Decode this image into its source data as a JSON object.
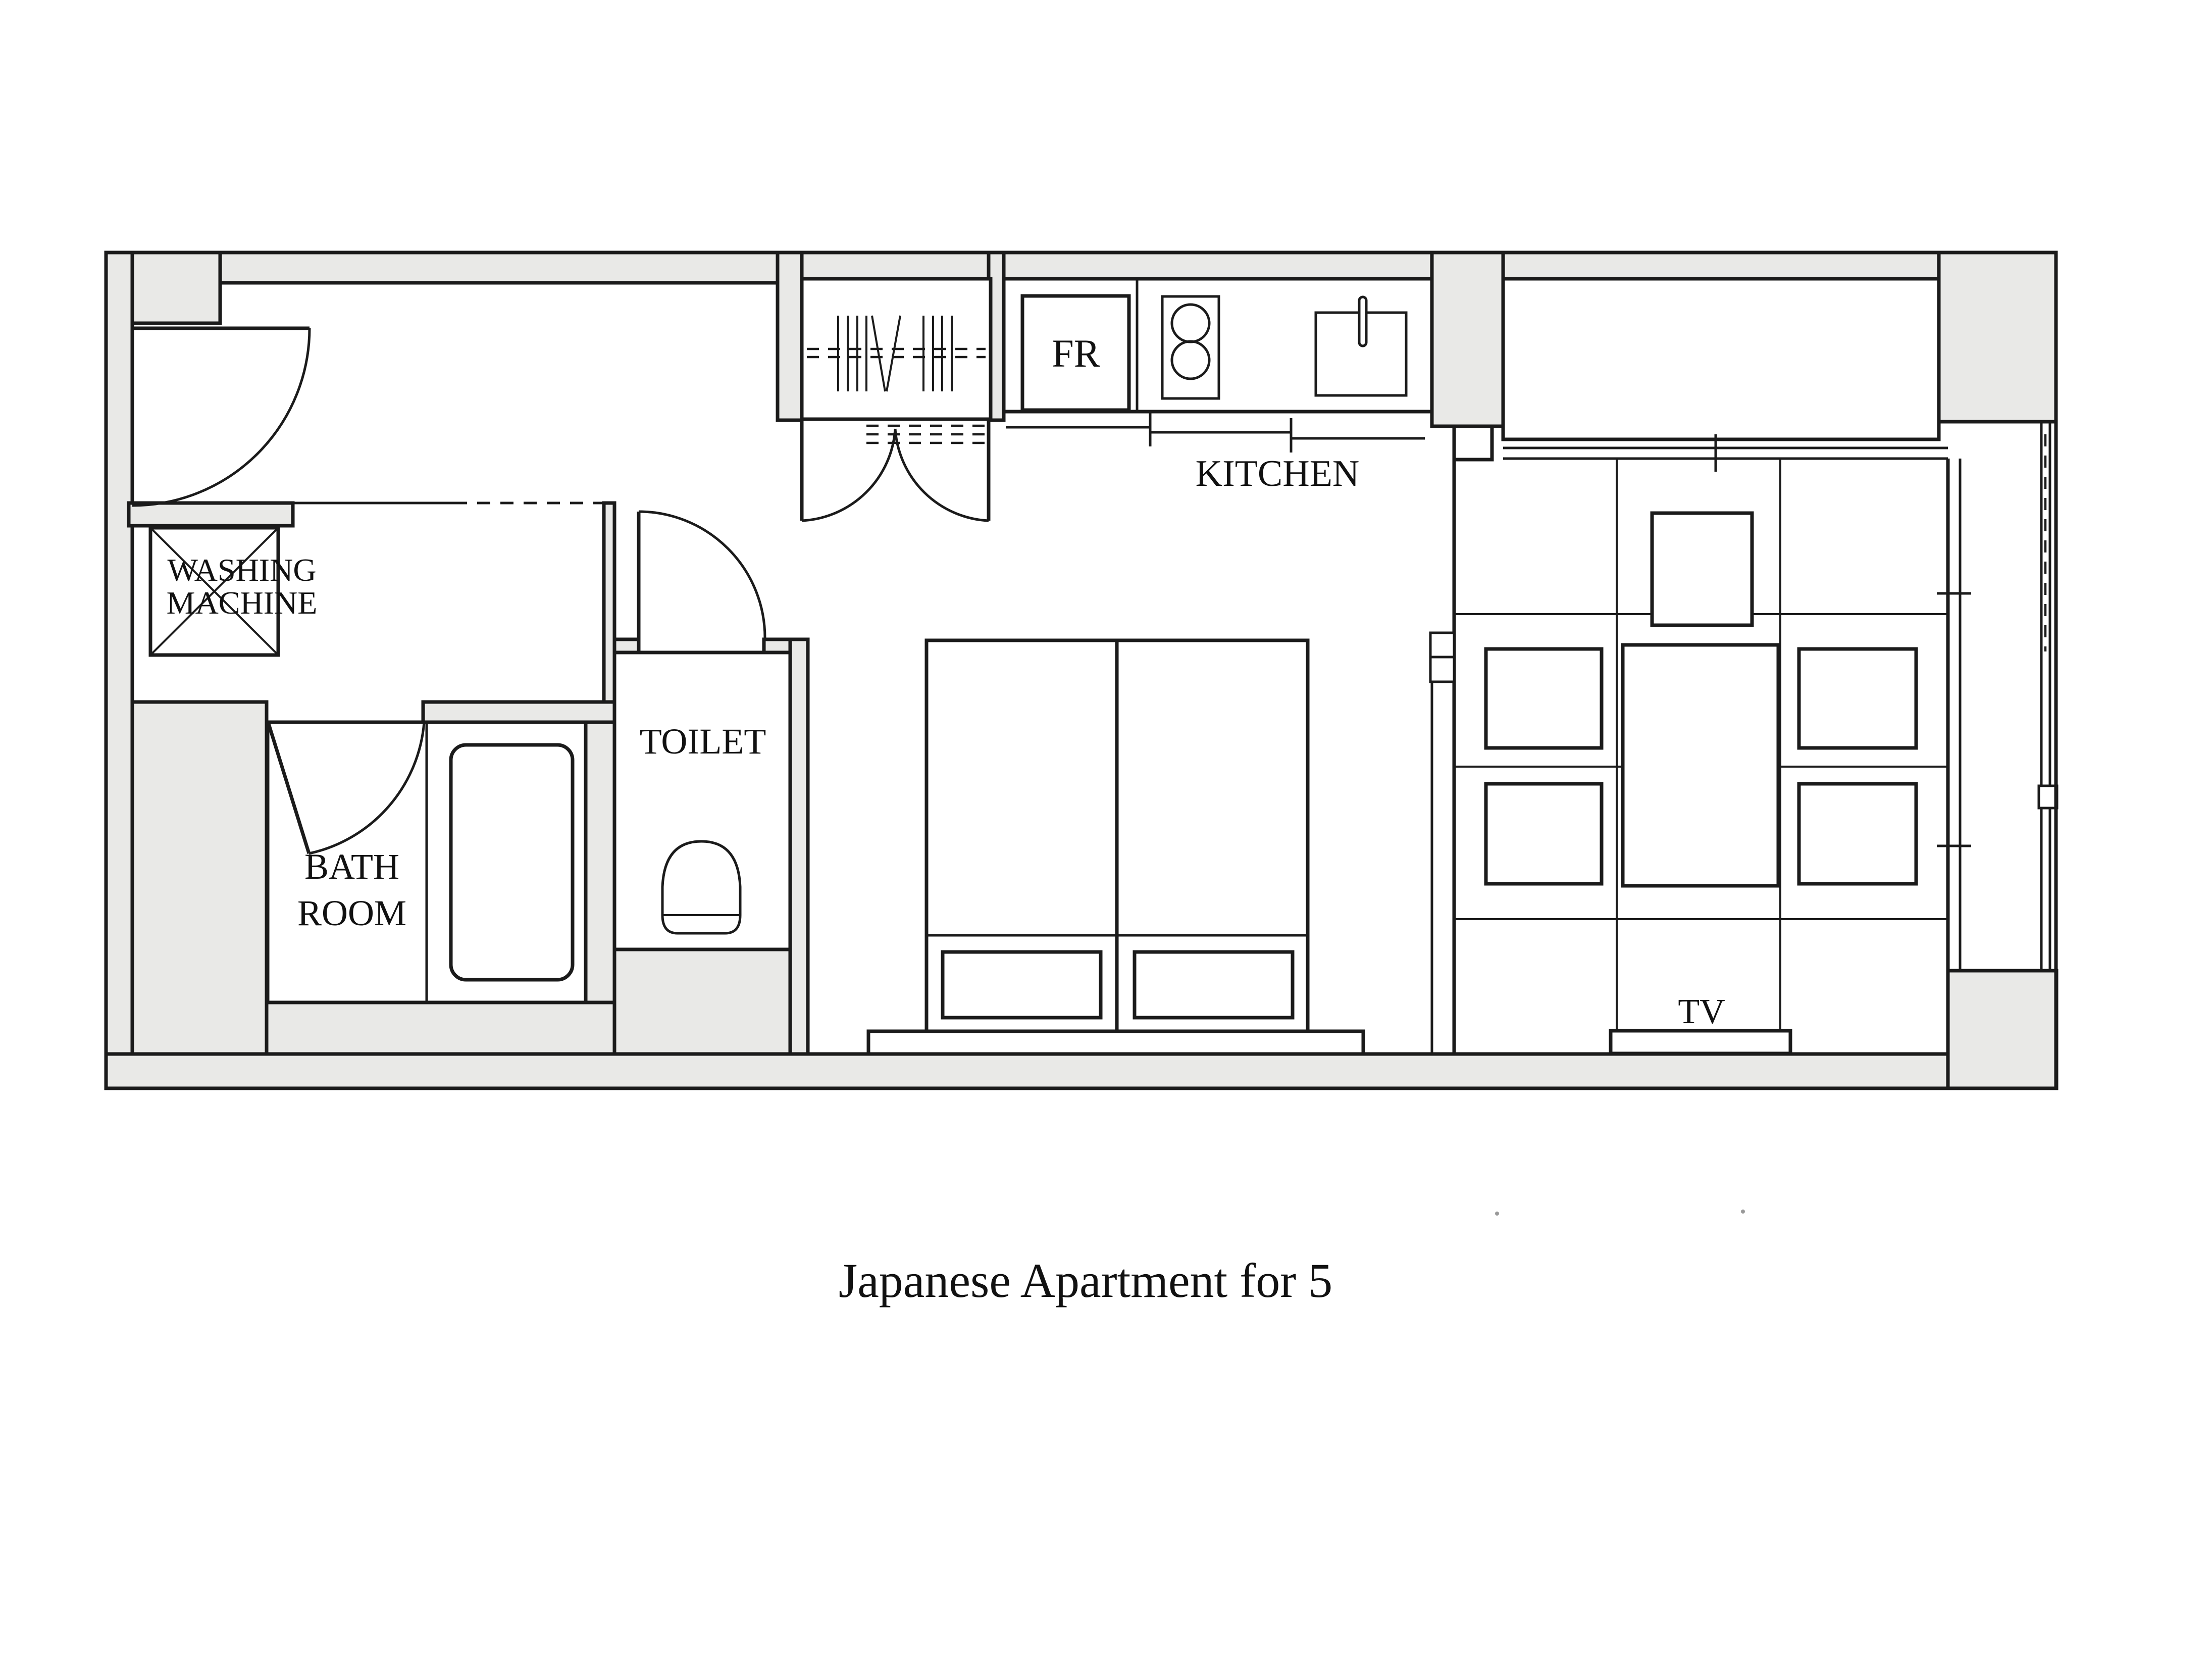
{
  "plan": {
    "caption": "Japanese Apartment for 5",
    "labels": {
      "washing_machine_line1": "WASHING",
      "washing_machine_line2": "MACHINE",
      "bath_room_line1": "BATH",
      "bath_room_line2": "ROOM",
      "toilet": "TOILET",
      "kitchen": "KITCHEN",
      "fridge": "FR",
      "tv": "TV"
    },
    "colors": {
      "wall_fill": "#e9e9e7",
      "line": "#1b1b1b",
      "text": "#111111",
      "background": "#ffffff"
    }
  }
}
